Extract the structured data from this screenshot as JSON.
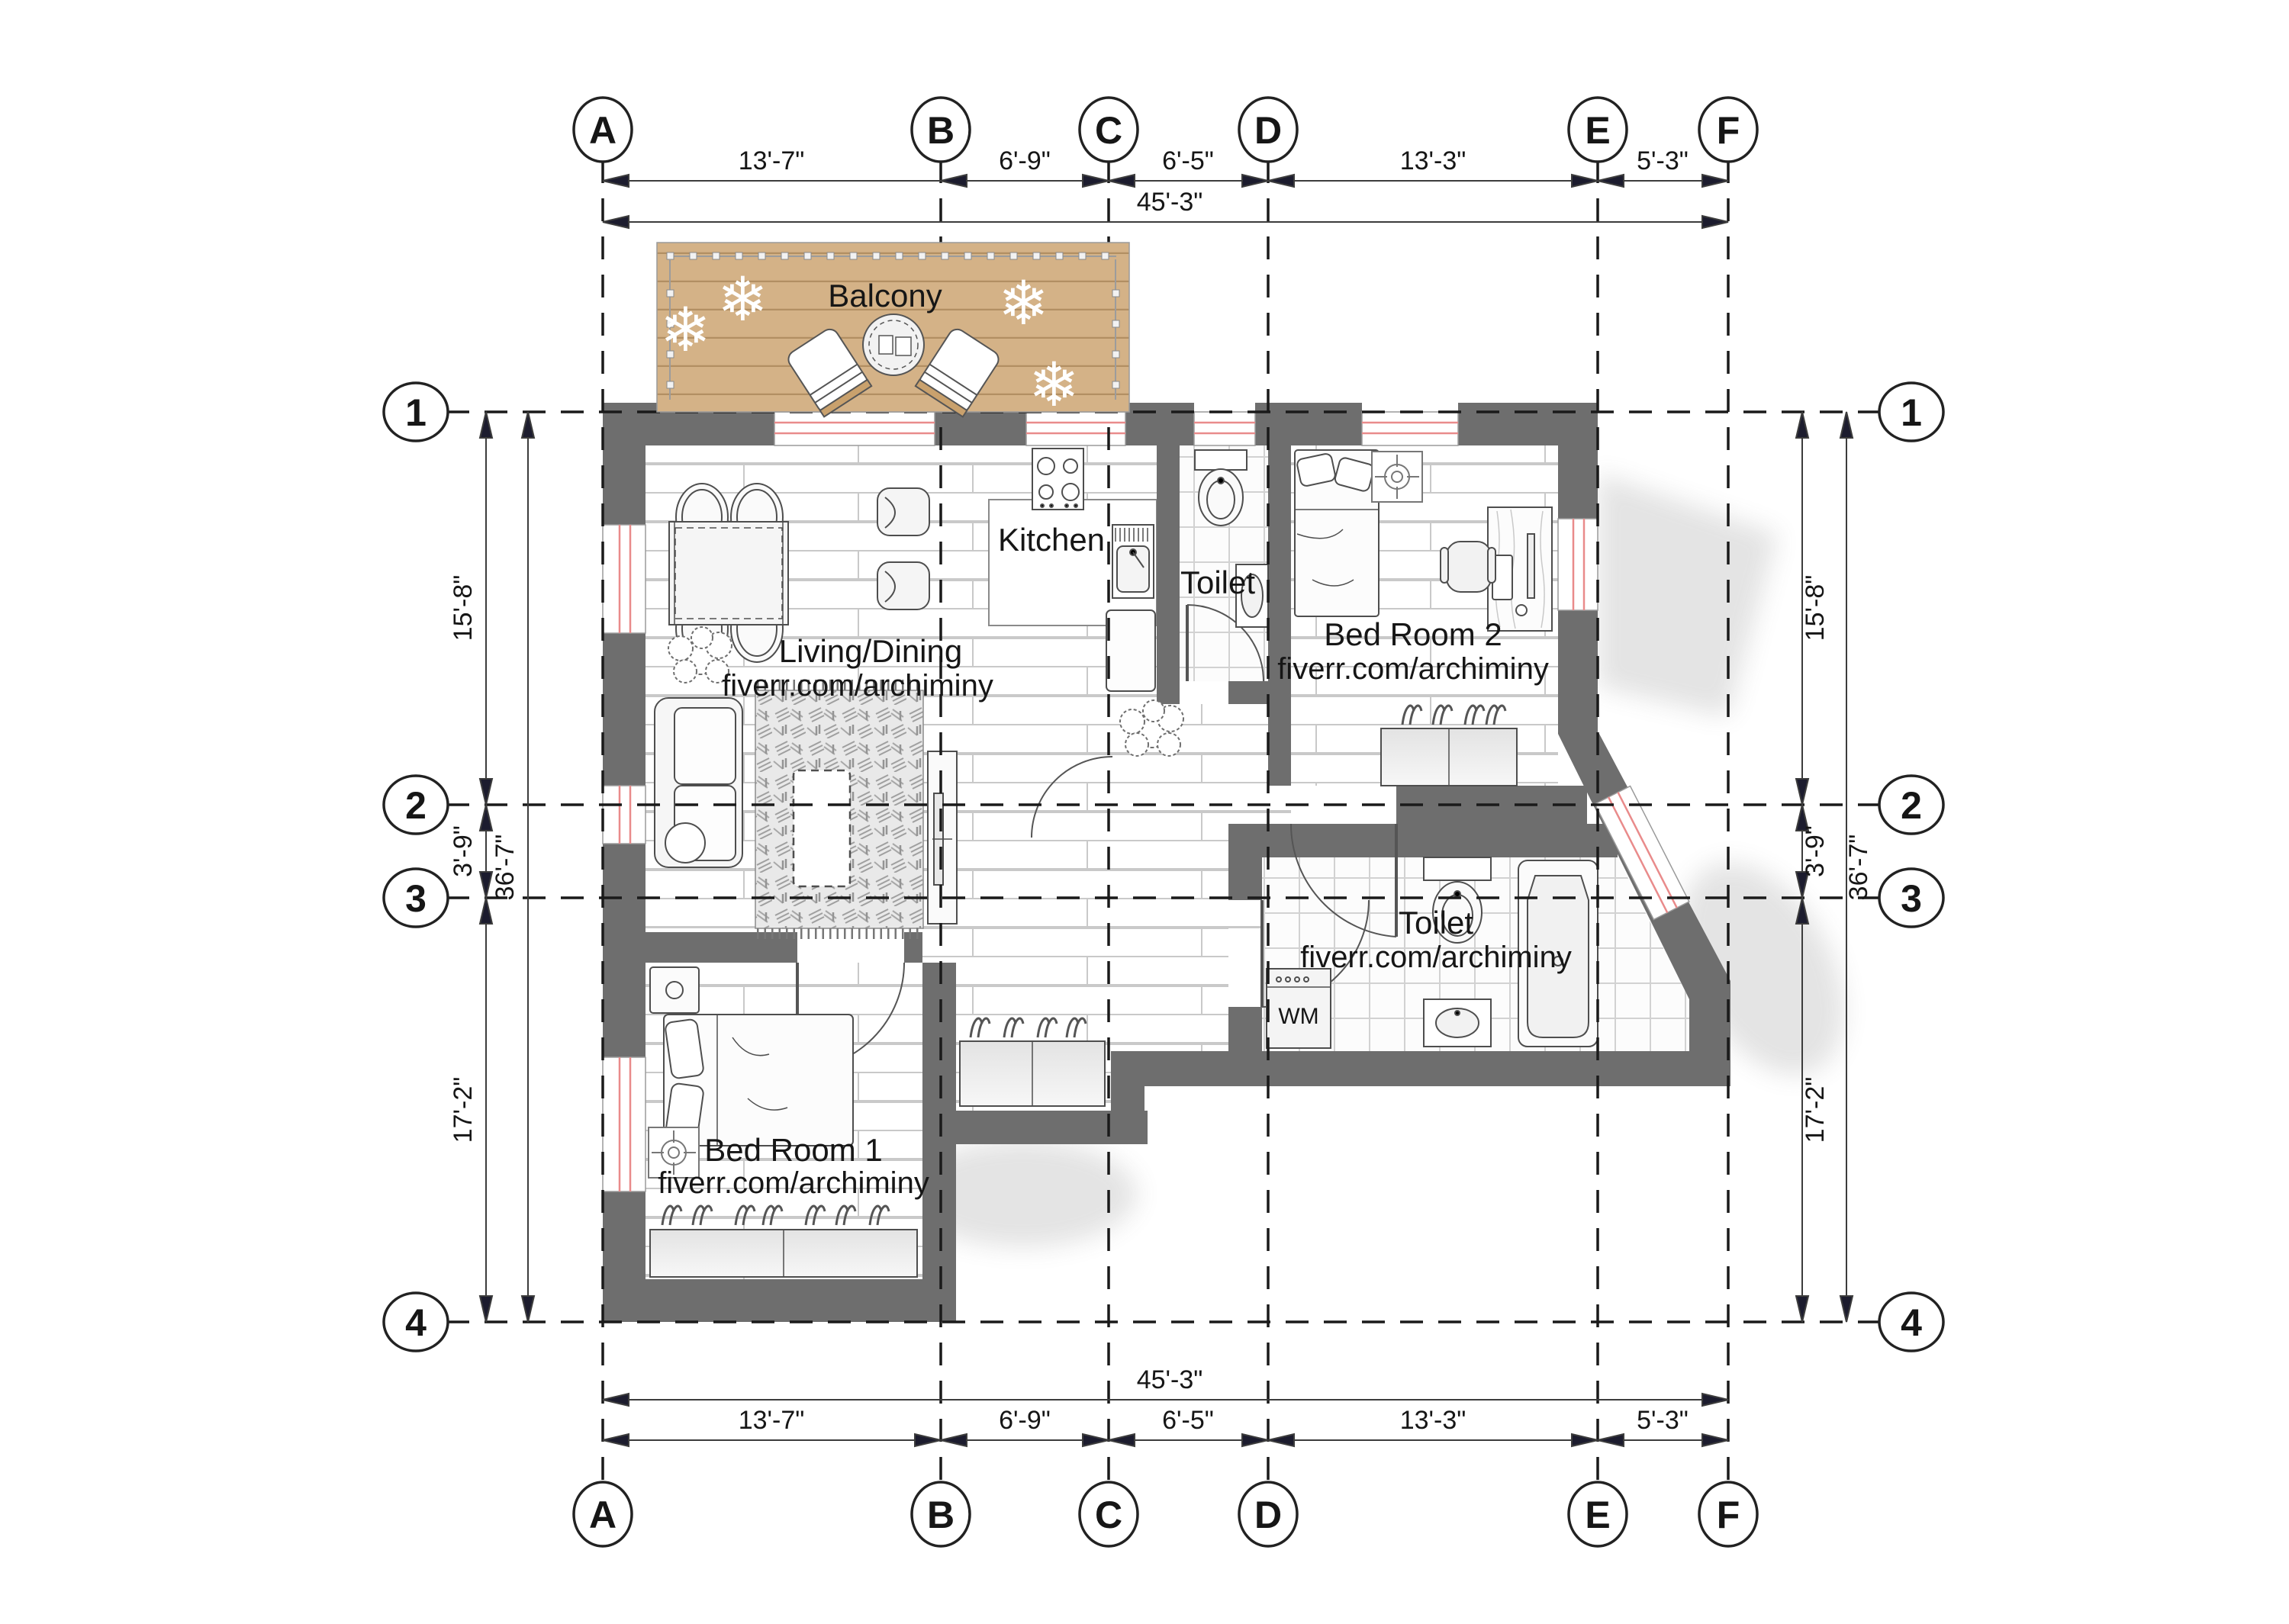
{
  "grid": {
    "columns": [
      {
        "label": "A"
      },
      {
        "label": "B"
      },
      {
        "label": "C"
      },
      {
        "label": "D"
      },
      {
        "label": "E"
      },
      {
        "label": "F"
      }
    ],
    "rows": [
      {
        "label": "1"
      },
      {
        "label": "2"
      },
      {
        "label": "3"
      },
      {
        "label": "4"
      }
    ]
  },
  "dimensions": {
    "top": {
      "segments": [
        "13'-7\"",
        "6'-9\"",
        "6'-5\"",
        "13'-3\"",
        "5'-3\""
      ],
      "overall": "45'-3\""
    },
    "bottom": {
      "segments": [
        "13'-7\"",
        "6'-9\"",
        "6'-5\"",
        "13'-3\"",
        "5'-3\""
      ],
      "overall": "45'-3\""
    },
    "left": {
      "segments": [
        "15'-8\"",
        "3'-9\"",
        "17'-2\""
      ],
      "overall": "36'-7\""
    },
    "right": {
      "segments": [
        "15'-8\"",
        "3'-9\"",
        "17'-2\""
      ],
      "overall": "36'-7\""
    }
  },
  "rooms": {
    "balcony": {
      "label": "Balcony"
    },
    "kitchen": {
      "label": "Kitchen"
    },
    "toilet_top": {
      "label": "Toilet"
    },
    "living": {
      "label": "Living/Dining",
      "watermark": "fiverr.com/archiminy"
    },
    "bedroom2": {
      "label": "Bed Room 2",
      "watermark": "fiverr.com/archiminy"
    },
    "toilet_bottom": {
      "label": "Toilet",
      "watermark": "fiverr.com/archiminy",
      "washing_machine": "WM"
    },
    "bedroom1": {
      "label": "Bed Room 1",
      "watermark": "fiverr.com/archiminy"
    }
  },
  "colors": {
    "wall": "#6e6e6e",
    "balcony_wood": "#d4b287",
    "balcony_plank_line": "#b28f63",
    "window_accent": "#e98b8b",
    "floor_line": "#c9c9c9",
    "tile_line": "#d2d2d2",
    "grid_dash": "#1a1a1a",
    "dimension": "#3c3c3c",
    "text": "#161616",
    "furniture_stroke": "#4e4e4e"
  }
}
